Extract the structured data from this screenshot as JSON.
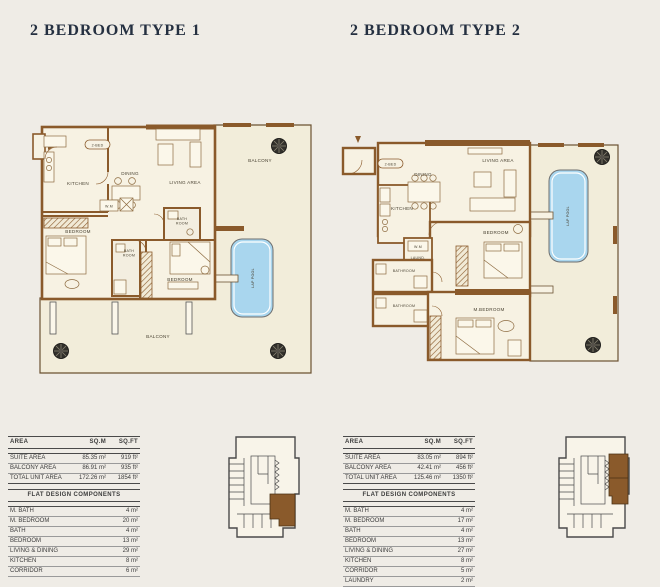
{
  "page": {
    "background": "#efece6",
    "accent_brown": "#8a5a2b",
    "pool_blue": "#a9d6ee",
    "title_color": "#253041"
  },
  "type1": {
    "title": "2 BEDROOM TYPE 1",
    "plan": {
      "badge": "2-BED",
      "labels": {
        "kitchen": "KITCHEN",
        "dining": "DINING",
        "living_area": "LIVING AREA",
        "balcony_top": "BALCONY",
        "balcony_bottom": "BALCONY",
        "bedroom_left": "BEDROOM",
        "bedroom_right": "BEDROOM",
        "bath_top_l1": "BATH",
        "bath_top_l2": "ROOM",
        "bath_mid_l1": "BATH",
        "bath_mid_l2": "ROOM",
        "wm": "W.M",
        "lap_pool": "LAP POOL"
      }
    },
    "table": {
      "headers": [
        "AREA",
        "SQ.M",
        "SQ.FT"
      ],
      "rows": [
        {
          "label": "SUITE AREA",
          "sqm": "85.35 m²",
          "sqft": "919 ft²"
        },
        {
          "label": "BALCONY AREA",
          "sqm": "86.91 m²",
          "sqft": "935 ft²"
        },
        {
          "label": "TOTAL UNIT AREA",
          "sqm": "172.26 m²",
          "sqft": "1854 ft²"
        }
      ],
      "components_title": "FLAT DESIGN COMPONENTS",
      "components": [
        {
          "label": "M. BATH",
          "value": "4 m²"
        },
        {
          "label": "M. BEDROOM",
          "value": "20 m²"
        },
        {
          "label": "BATH",
          "value": "4 m²"
        },
        {
          "label": "BEDROOM",
          "value": "13 m²"
        },
        {
          "label": "LIVING & DINING",
          "value": "29 m²"
        },
        {
          "label": "KITCHEN",
          "value": "8 m²"
        },
        {
          "label": "CORRIDOR",
          "value": "6 m²"
        }
      ]
    }
  },
  "type2": {
    "title": "2 BEDROOM TYPE 2",
    "plan": {
      "badge": "2-BED",
      "labels": {
        "kitchen": "KITCHEN",
        "dining": "DINING",
        "living_area": "LIVING AREA",
        "bedroom": "BEDROOM",
        "m_bedroom": "M.BEDROOM",
        "bathroom_1": "BATHROOM",
        "bathroom_2": "BATHROOM",
        "wm": "W.M",
        "laundry": "LAUND.",
        "lap_pool": "LAP POOL"
      }
    },
    "table": {
      "headers": [
        "AREA",
        "SQ.M",
        "SQ.FT"
      ],
      "rows": [
        {
          "label": "SUITE AREA",
          "sqm": "83.05 m²",
          "sqft": "894 ft²"
        },
        {
          "label": "BALCONY AREA",
          "sqm": "42.41 m²",
          "sqft": "456 ft²"
        },
        {
          "label": "TOTAL UNIT AREA",
          "sqm": "125.46 m²",
          "sqft": "1350 ft²"
        }
      ],
      "components_title": "FLAT DESIGN COMPONENTS",
      "components": [
        {
          "label": "M. BATH",
          "value": "4 m²"
        },
        {
          "label": "M. BEDROOM",
          "value": "17 m²"
        },
        {
          "label": "BATH",
          "value": "4 m²"
        },
        {
          "label": "BEDROOM",
          "value": "13 m²"
        },
        {
          "label": "LIVING & DINING",
          "value": "27 m²"
        },
        {
          "label": "KITCHEN",
          "value": "8 m²"
        },
        {
          "label": "CORRIDOR",
          "value": "5 m²"
        },
        {
          "label": "LAUNDRY",
          "value": "2 m²"
        }
      ]
    }
  }
}
